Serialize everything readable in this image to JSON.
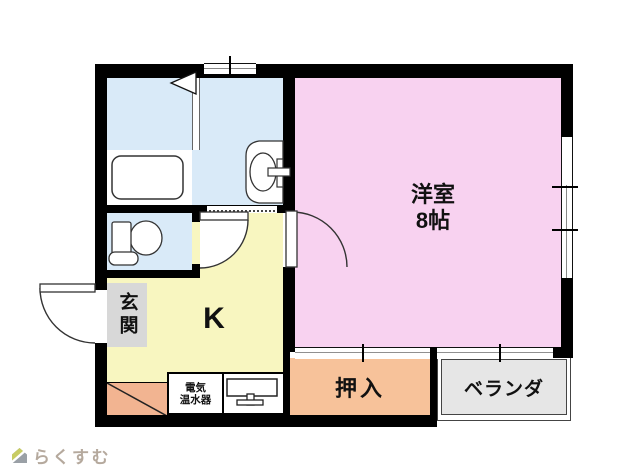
{
  "plan": {
    "rooms": {
      "western_room": {
        "name_label": "洋室",
        "size_label": "8帖",
        "color": "#f8d2f0"
      },
      "kitchen": {
        "label": "K",
        "color": "#f8f6c0"
      },
      "entrance": {
        "label": "玄関",
        "color": "#d8d8d8"
      },
      "closet": {
        "label": "押入",
        "color": "#f7c29a"
      },
      "veranda": {
        "label": "ベランダ",
        "color": "#e6e6e6"
      },
      "bathroom": {
        "color": "#d9eaf8"
      },
      "toilet": {
        "color": "#d9eaf8"
      },
      "porch": {
        "color": "#f2b491"
      }
    },
    "equipment": {
      "water_heater_label_line1": "電気",
      "water_heater_label_line2": "温水器"
    },
    "wall_color": "#000000"
  },
  "branding": {
    "logo_text": "らくすむ",
    "text_color": "#b5a99d",
    "roof_color": "#c8cc63",
    "body_color": "#9aa0a6"
  }
}
